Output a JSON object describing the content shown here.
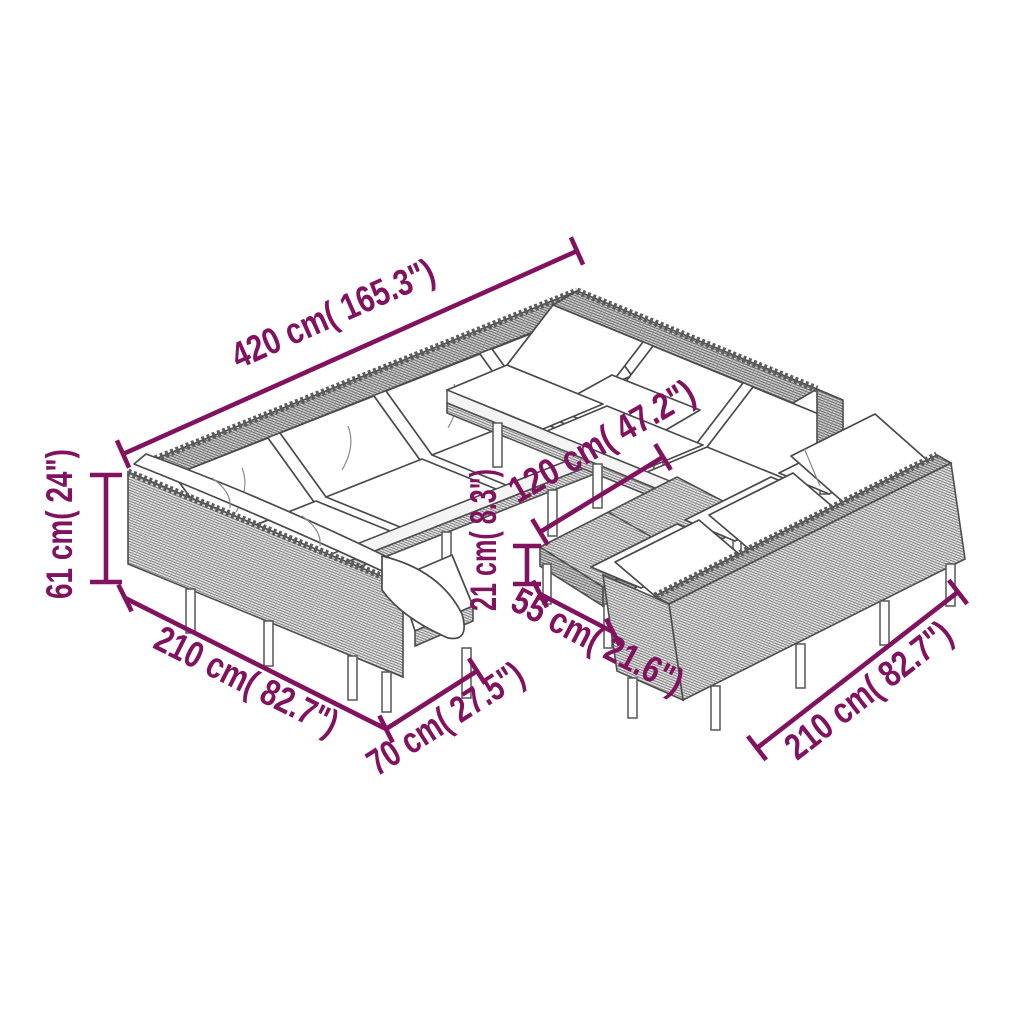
{
  "diagram": {
    "type": "product-dimension-drawing",
    "subject": "U-shaped modular poly-rattan garden lounge set with white cushions and coffee table",
    "accent_color": "#82125f",
    "artwork_color": "#4d4d4d",
    "background_color": "#ffffff",
    "dimensions": [
      {
        "name": "back-row-length",
        "value": "420 cm",
        "label": "420 cm( 165.3\")"
      },
      {
        "name": "seat-back-height",
        "value": "61 cm",
        "label": "61 cm( 24\")"
      },
      {
        "name": "left-row-length",
        "value": "210 cm",
        "label": "210 cm( 82.7\")"
      },
      {
        "name": "module-width",
        "value": "70 cm",
        "label": "70 cm( 27.5\")"
      },
      {
        "name": "table-length",
        "value": "120 cm",
        "label": "120 cm( 47.2\")"
      },
      {
        "name": "table-height",
        "value": "21 cm",
        "label": "21 cm( 8.3\")"
      },
      {
        "name": "table-width",
        "value": "55 cm",
        "label": "55 cm( 21.6\")"
      },
      {
        "name": "right-sofa-length",
        "value": "210 cm",
        "label": "210 cm( 82.7\")"
      }
    ]
  }
}
